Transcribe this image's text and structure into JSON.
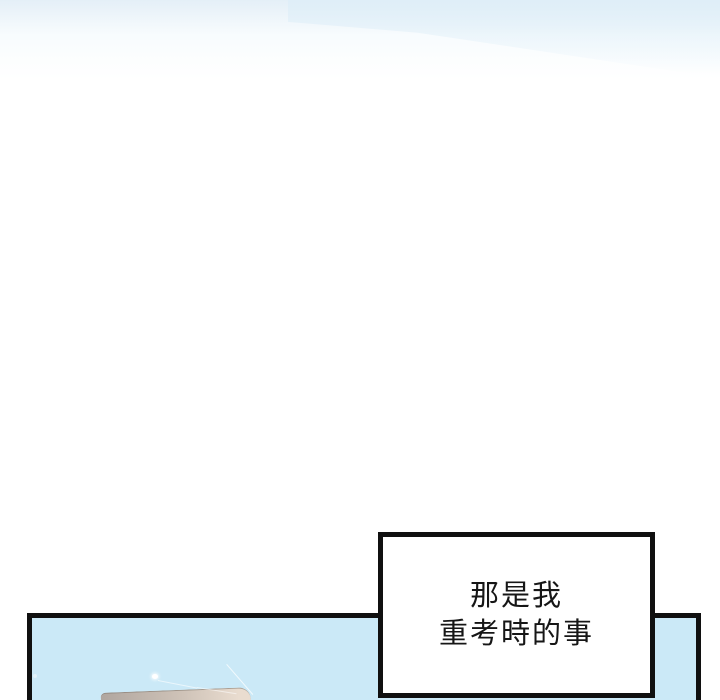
{
  "speech_bubble": {
    "lines": [
      "那是我",
      "重考時的事"
    ]
  },
  "colors": {
    "ink": "#101010",
    "panel_sky": "#cbe9f7",
    "top_haze": "#e4eff7",
    "roof_dark": "#b0a69f",
    "roof_mid": "#cfc3b8",
    "roof_light": "#e9dccf",
    "glint_white": "#ffffff"
  }
}
